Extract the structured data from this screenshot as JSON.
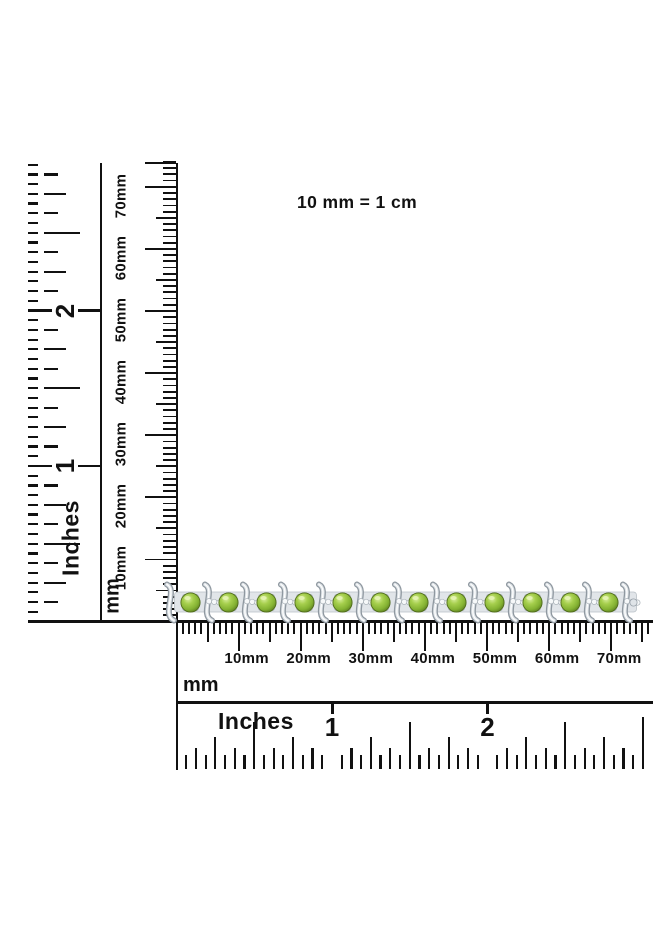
{
  "note": {
    "text": "10 mm = 1 cm"
  },
  "rulers": {
    "left_inches": {
      "unit": "Inches",
      "numerals": [
        "1",
        "2"
      ]
    },
    "left_mm": {
      "unit": "mm",
      "labels": [
        "10mm",
        "20mm",
        "30mm",
        "40mm",
        "50mm",
        "60mm",
        "70mm"
      ]
    },
    "bottom_mm": {
      "unit": "mm",
      "labels": [
        "10mm",
        "20mm",
        "30mm",
        "40mm",
        "50mm",
        "60mm",
        "70mm"
      ]
    },
    "bottom_inches": {
      "unit": "Inches",
      "numerals": [
        "1",
        "2"
      ]
    }
  },
  "bracelet": {
    "stone_count": 12,
    "stone_color": "#84b232",
    "metal_color": "#e1e5e9",
    "accent_color": "#f6f8f9"
  }
}
